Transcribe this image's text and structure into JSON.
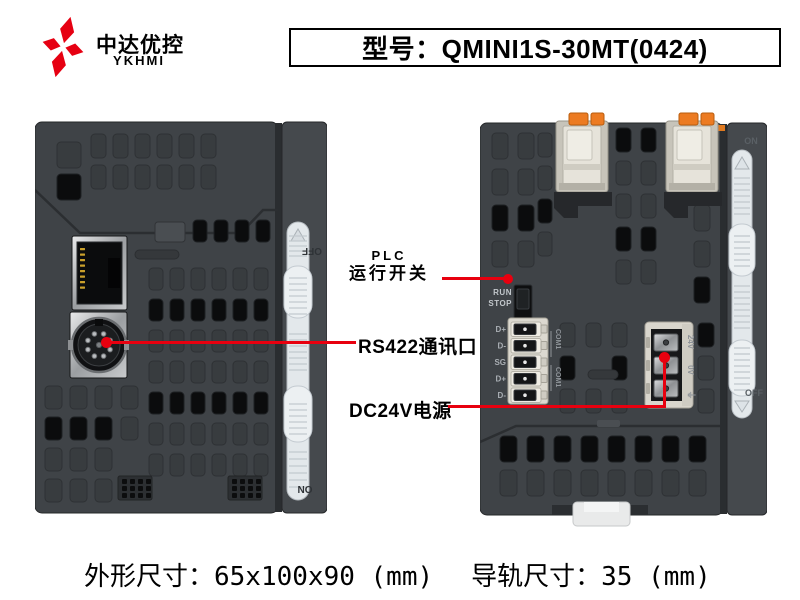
{
  "brand": {
    "name_cn": "中达优控",
    "name_en": "YKHMI"
  },
  "header": {
    "model_label": "型号：QMINI1S-30MT(0424)"
  },
  "annotations": {
    "plc_switch_line1": "PLC",
    "plc_switch_line2": "运行开关",
    "rs422_label": "RS422通讯口",
    "dc24v_label": "DC24V电源"
  },
  "device_left": {
    "side_top_label": "OFF",
    "side_bottom_label": "ON"
  },
  "device_right": {
    "run_label": "RUN",
    "stop_label": "STOP",
    "terminal_labels": [
      "D+",
      "D-",
      "SG",
      "D+",
      "D-"
    ],
    "com_label_top": "COM1",
    "com_label_bottom": "COM1",
    "power_labels": [
      "24V",
      "0V",
      "⏚"
    ],
    "side_top_label": "ON",
    "side_bottom_label": "OFF"
  },
  "footer": {
    "dimensions": "外形尺寸：65x100x90 (mm)",
    "rail": "导轨尺寸：35 (mm)"
  },
  "colors": {
    "accent_red": "#e8000f",
    "logo_red": "#e60012",
    "device_body": "#3f4347",
    "device_strip": "#45494d",
    "terminal_orange": "#ec7b22",
    "slider_white": "#e3e8eb"
  }
}
